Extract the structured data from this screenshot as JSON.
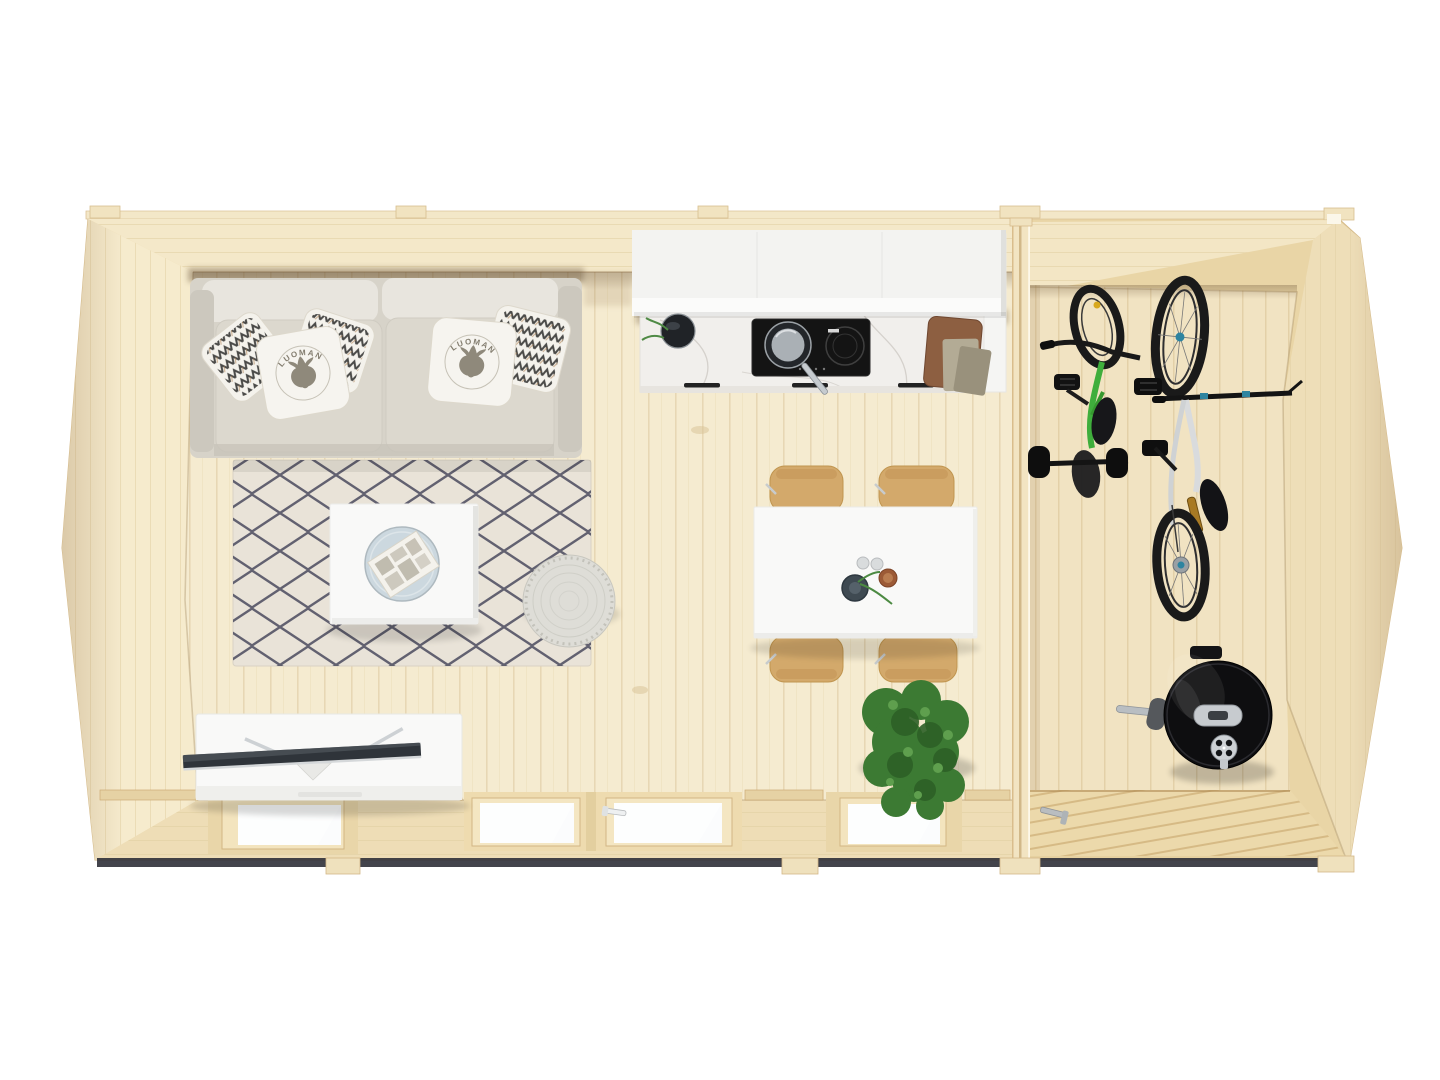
{
  "image": {
    "background": "#ffffff",
    "view": "top-down-interior-render"
  },
  "text": {
    "pillow_brand": "LUOMAN"
  },
  "palette": {
    "shell_outer": "#e9d5a6",
    "roof_edge": "#f3e7c8",
    "wall_face": "#f6ebcd",
    "wall_face_shade": "#eeddb6",
    "floor_main": "#f5ebd0",
    "floor_storage": "#f1e3c2",
    "deck_door": "#ecd9ab",
    "plank_line": "#d9c49a",
    "partition": "#f2e4c2",
    "rug_base": "#e9e3d8",
    "rug_pattern": "#4a4a5e",
    "sofa_base": "#d7d3c9",
    "sofa_back": "#e8e5de",
    "pillow_white": "#f4f2ec",
    "white_furniture": "#f9f9f8",
    "marble": "#f1efec",
    "cooktop": "#141414",
    "chair_wood": "#d3a96b",
    "cutting_board": "#8d5f41",
    "plant_green": "#3c7a33",
    "bike_green": "#3fae3c",
    "bike_black": "#1a1a1a",
    "metal": "#c9cdd1",
    "grill_black": "#0e0e10",
    "glass": "#fbfcfd",
    "tv_screen": "#2f343a",
    "under_slab": "#2f3038"
  },
  "objects": {
    "shell": [
      "roof-edge",
      "roof-tabs",
      "left-wall",
      "top-wall",
      "right-wall",
      "bottom-wall",
      "partition-wall",
      "foundation-feet"
    ],
    "living": [
      "sofa",
      "moose-pillows",
      "pattern-pillows",
      "area-rug",
      "coffee-table",
      "serving-tray",
      "newspaper",
      "pouf",
      "tv-stand",
      "tv"
    ],
    "kitchen": [
      "upper-cabinet",
      "countertop",
      "induction-cooktop",
      "frying-pan",
      "herb-bowl",
      "cutting-board",
      "kitchen-towels",
      "drawer-handles"
    ],
    "dining": [
      "dining-table",
      "dining-chairs",
      "glasses",
      "bowl",
      "vase",
      "potted-plant"
    ],
    "openings": [
      "window-left",
      "glass-double-door",
      "door-handle",
      "window-right"
    ],
    "storage": [
      "kids-bike",
      "mountain-bike",
      "kettle-grill",
      "deck-door",
      "deck-door-handle"
    ]
  }
}
